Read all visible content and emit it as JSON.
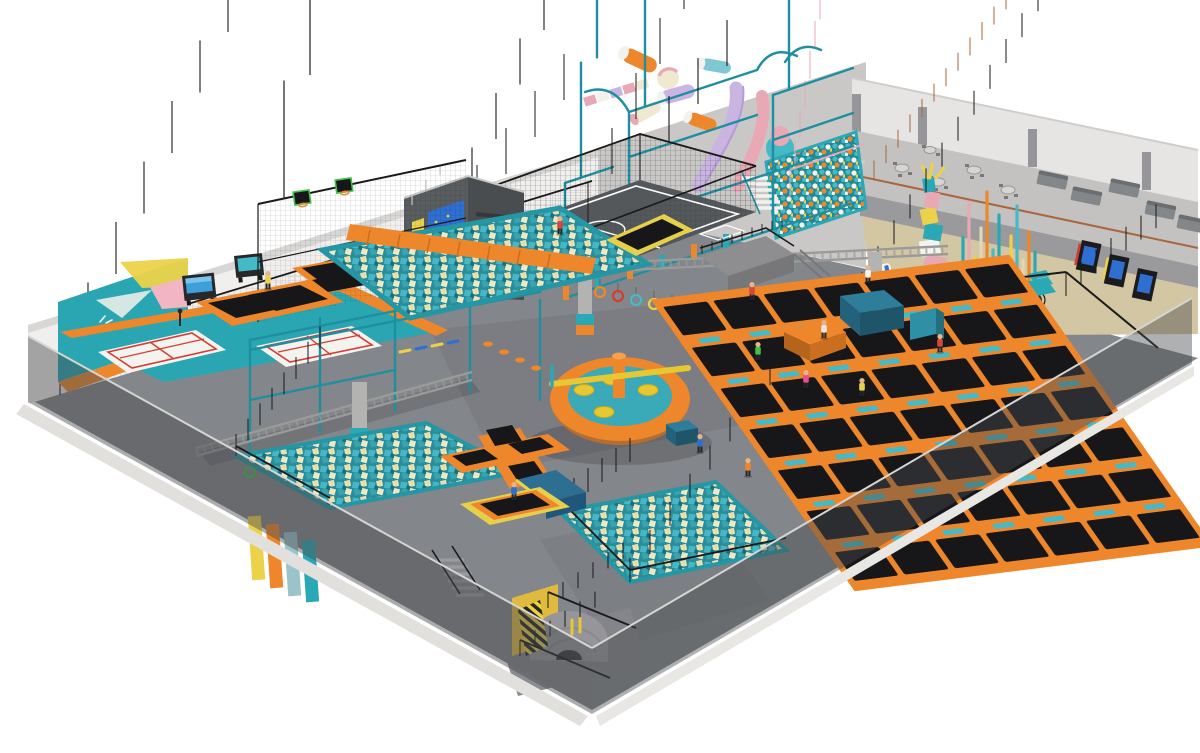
{
  "scene": {
    "type": "3D isometric architectural render",
    "subject": "Indoor trampoline park and adventure play center interior",
    "people_count": 14,
    "walls": "semi-transparent gray front walls, white and gray back walls",
    "zones": [
      {
        "id": "kids-play-structure",
        "label": "Multi-level soft play structure with tubes, slides and ball pool"
      },
      {
        "id": "football-court",
        "label": "Caged mini football court with white markings"
      },
      {
        "id": "mezzanine-cafe",
        "label": "Mezzanine cafe with round tables, chairs and gray sofas"
      },
      {
        "id": "under-mezzanine",
        "label": "Arcade screens, climbing pole forest and twisted rope sculpture"
      },
      {
        "id": "trampoline-grid",
        "label": "Main free-jump trampoline court with orange pads and teal accents"
      },
      {
        "id": "wipeout-sweeper",
        "label": "Inflatable wipeout sweeper ring with rotating yellow arm"
      },
      {
        "id": "foam-pit-center",
        "label": "Foam cube pit crossed by orange tumbling runway"
      },
      {
        "id": "ring-course",
        "label": "Overhead truss courses with hanging rings and tires"
      },
      {
        "id": "ninja-frame",
        "label": "Teal ninja obstacle frame with monkey bars"
      },
      {
        "id": "slam-dunk-zone",
        "label": "Basketball slam-dunk trampoline lanes with green backboards"
      },
      {
        "id": "dodgeball-courts",
        "label": "Two white mini courts with red markings on teal floor"
      },
      {
        "id": "climbing-wall",
        "label": "Climbing wall with geometric graphics and logo"
      },
      {
        "id": "climbing-tower",
        "label": "Gray climbing tower with blue wall panel"
      },
      {
        "id": "wedge-trampolines",
        "label": "Cross trampoline, yellow square trampoline and blue wedge"
      },
      {
        "id": "foam-pits-bottom",
        "label": "Foam cube pits with black railings"
      },
      {
        "id": "entrance-dome",
        "label": "Entrance arch with gray dome and hazard stairs"
      }
    ]
  },
  "palette": {
    "bg": "#ffffff",
    "floor": "#83868a",
    "floor_shadow": "#74777b",
    "wall_white": "#f0efed",
    "wall_gray": "#c9c8c6",
    "wall_right": "#e6e5e3",
    "mezz_floor": "#c3c2c0",
    "mezz_fascia": "#9a9a9c",
    "rail_bronze": "#a8673e",
    "sofa": "#84878a",
    "table": "#d6d5d3",
    "under_floor_tan": "#d2c7a2",
    "orange": "#ee872b",
    "orange_dark": "#c96f1f",
    "teal": "#2ba8b5",
    "teal_deep": "#1f8fa0",
    "teal_bright": "#45b9c6",
    "bed_black": "#17171a",
    "foam_base": "#2a8b99",
    "foam_teal": "#43b8c6",
    "foam_cream": "#e9dfae",
    "yellow": "#ecd24a",
    "blue": "#2f6fd0",
    "blue_steel": "#2e7d9a",
    "blue_wedge": "#2c6f93",
    "lavender": "#c9b4e2",
    "pink": "#e8a8b4",
    "red": "#d43c30",
    "green": "#3fc24a",
    "skin": "#e8b48a",
    "truss": "#9a9a98",
    "fence": "#1a1a1c",
    "court_white": "#f4f3ef",
    "court_dark": "#54585a",
    "glass_wall": "rgba(72,74,78,0.46)"
  }
}
